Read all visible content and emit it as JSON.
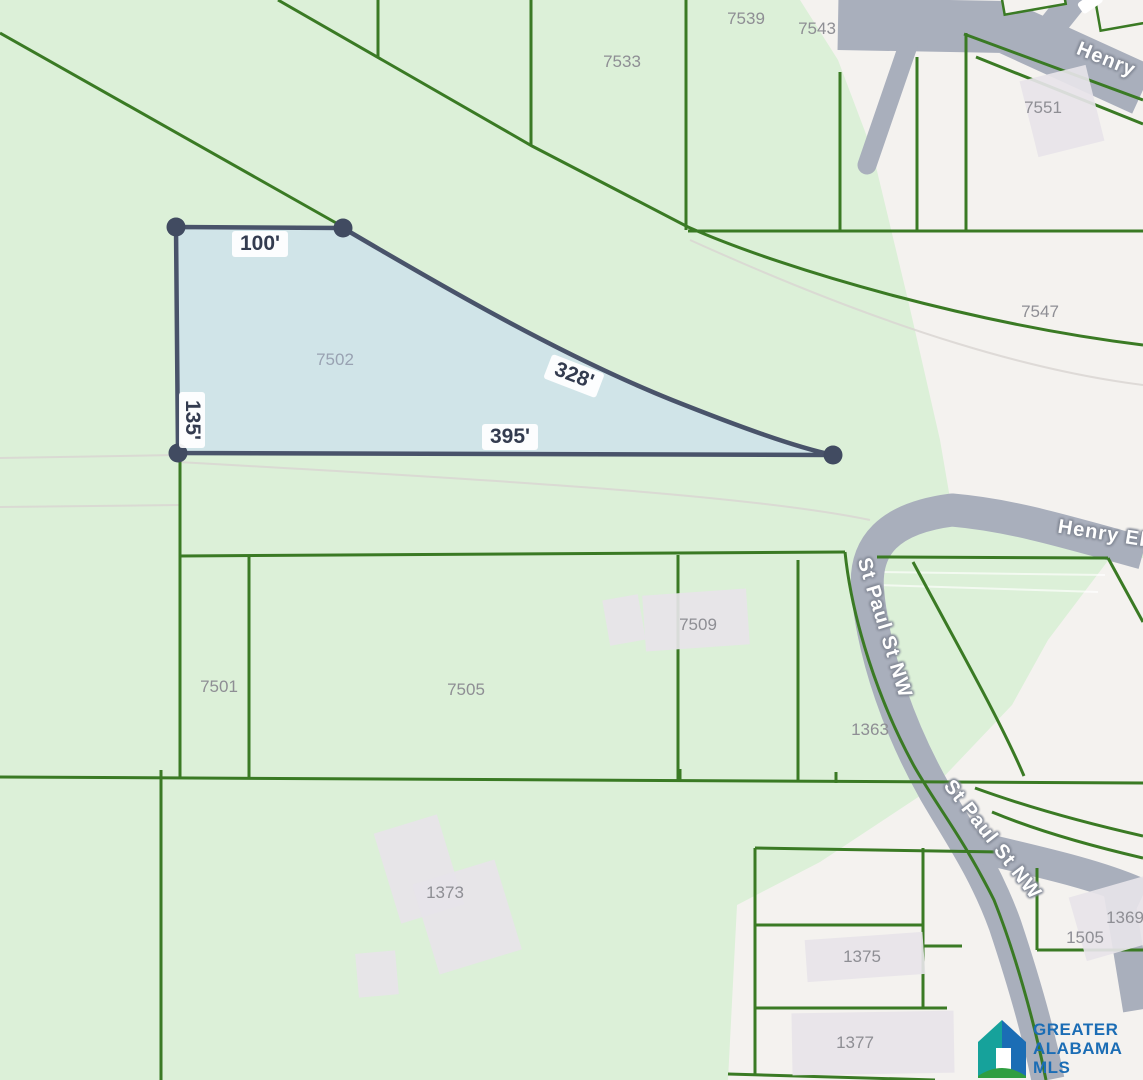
{
  "map": {
    "highlighted_parcel": {
      "id": "7502",
      "dimensions": [
        "100'",
        "135'",
        "328'",
        "395'"
      ]
    },
    "parcel_labels": [
      {
        "text": "7533",
        "x": 622,
        "y": 62
      },
      {
        "text": "7539",
        "x": 746,
        "y": 19
      },
      {
        "text": "7543",
        "x": 817,
        "y": 29
      },
      {
        "text": "7551",
        "x": 1043,
        "y": 108
      },
      {
        "text": "7547",
        "x": 1040,
        "y": 312
      },
      {
        "text": "7502",
        "x": 335,
        "y": 360,
        "muted": true
      },
      {
        "text": "7501",
        "x": 219,
        "y": 687
      },
      {
        "text": "7505",
        "x": 466,
        "y": 690
      },
      {
        "text": "7509",
        "x": 698,
        "y": 625
      },
      {
        "text": "1363",
        "x": 870,
        "y": 730
      },
      {
        "text": "1373",
        "x": 445,
        "y": 893
      },
      {
        "text": "1375",
        "x": 862,
        "y": 957
      },
      {
        "text": "1377",
        "x": 855,
        "y": 1043
      },
      {
        "text": "1369",
        "x": 1125,
        "y": 918
      },
      {
        "text": "1505",
        "x": 1085,
        "y": 938
      }
    ],
    "street_labels": [
      {
        "text": "Henry",
        "x": 1106,
        "y": 60,
        "rot": 22
      },
      {
        "text": "Henry El",
        "x": 1102,
        "y": 534,
        "rot": 9
      },
      {
        "text": "St Paul St NW",
        "x": 884,
        "y": 628,
        "rot": 73
      },
      {
        "text": "St Paul St NW",
        "x": 992,
        "y": 840,
        "rot": 52
      }
    ],
    "dimension_labels": [
      {
        "text": "100'",
        "x": 260,
        "y": 244,
        "rot": 0
      },
      {
        "text": "135'",
        "x": 192,
        "y": 420,
        "rot": 90
      },
      {
        "text": "328'",
        "x": 574,
        "y": 376,
        "rot": 21
      },
      {
        "text": "395'",
        "x": 510,
        "y": 437,
        "rot": 0
      }
    ]
  },
  "logo": {
    "line1": "GREATER",
    "line2": "ALABAMA",
    "line3": "MLS"
  },
  "colors": {
    "map_green": "#dcf0d8",
    "area_white": "#f4f2ef",
    "road_gray": "#a9afbc",
    "lot_line_green": "#3a7a24",
    "highlight_fill": "#cde0eb",
    "highlight_stroke": "#49536a",
    "parcel_label_gray": "#8e8e94",
    "dimension_text": "#333b4f",
    "logo_blue": "#1b6db5",
    "logo_teal": "#16a29b",
    "logo_green": "#2f9e41"
  }
}
